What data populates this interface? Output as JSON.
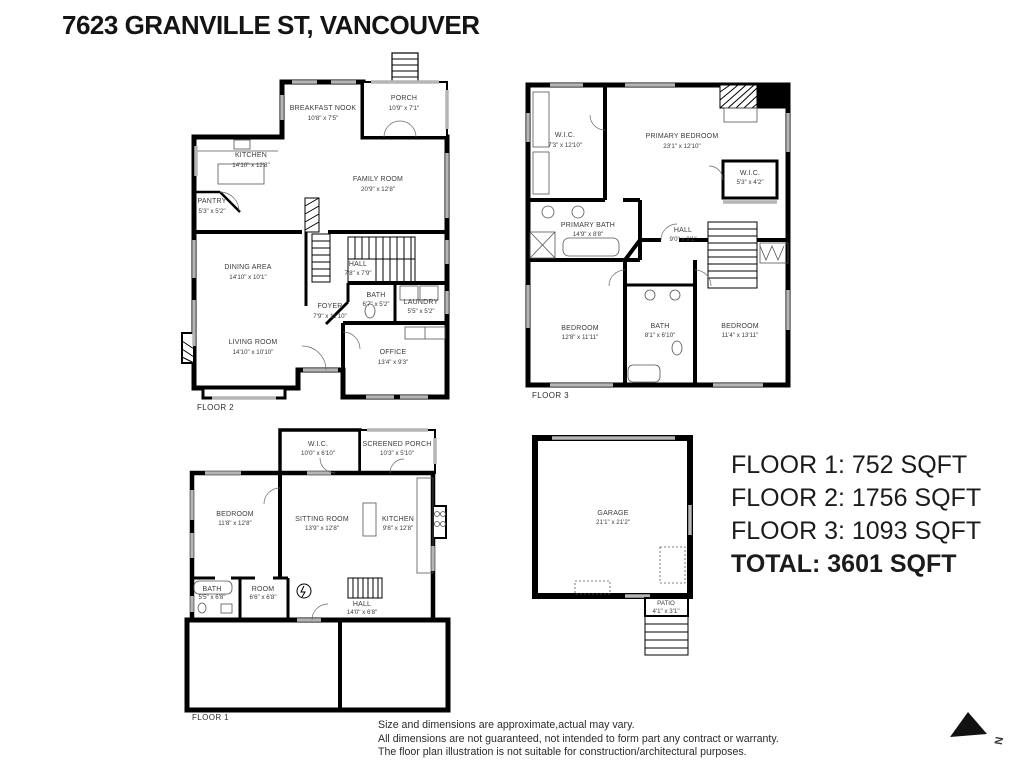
{
  "page": {
    "title": "7623 GRANVILLE ST, VANCOUVER"
  },
  "floor2": {
    "label": "FLOOR 2",
    "rooms": {
      "breakfast_nook": {
        "name": "BREAKFAST NOOK",
        "dims": "10'8\" x 7'5\""
      },
      "porch": {
        "name": "PORCH",
        "dims": "10'9\" x 7'1\""
      },
      "kitchen": {
        "name": "KITCHEN",
        "dims": "14'10\" x 12'8\""
      },
      "family_room": {
        "name": "FAMILY ROOM",
        "dims": "20'9\" x 12'8\""
      },
      "pantry": {
        "name": "PANTRY",
        "dims": "5'3\" x 5'2\""
      },
      "dining_area": {
        "name": "DINING AREA",
        "dims": "14'10\" x 10'1\""
      },
      "hall": {
        "name": "HALL",
        "dims": "7'8\" x 7'9\""
      },
      "foyer": {
        "name": "FOYER",
        "dims": "7'9\" x 11'10\""
      },
      "bath": {
        "name": "BATH",
        "dims": "6'7\" x 5'2\""
      },
      "laundry": {
        "name": "LAUNDRY",
        "dims": "5'5\" x 5'2\""
      },
      "living_room": {
        "name": "LIVING ROOM",
        "dims": "14'10\" x 10'10\""
      },
      "office": {
        "name": "OFFICE",
        "dims": "13'4\" x 9'3\""
      }
    }
  },
  "floor3": {
    "label": "FLOOR 3",
    "rooms": {
      "wic1": {
        "name": "W.I.C.",
        "dims": "7'3\" x 12'10\""
      },
      "primary_bedroom": {
        "name": "PRIMARY BEDROOM",
        "dims": "23'1\" x 12'10\""
      },
      "wic2": {
        "name": "W.I.C.",
        "dims": "5'3\" x 4'2\""
      },
      "primary_bath": {
        "name": "PRIMARY BATH",
        "dims": "14'9\" x 8'8\""
      },
      "hall": {
        "name": "HALL",
        "dims": "9'0\" x 9'1\""
      },
      "bedroom_left": {
        "name": "BEDROOM",
        "dims": "12'8\" x 11'11\""
      },
      "bath": {
        "name": "BATH",
        "dims": "8'1\" x 6'10\""
      },
      "bedroom_right": {
        "name": "BEDROOM",
        "dims": "11'4\" x 13'11\""
      }
    }
  },
  "floor1": {
    "label": "FLOOR 1",
    "rooms": {
      "wic": {
        "name": "W.I.C.",
        "dims": "10'0\" x 6'10\""
      },
      "screened_porch": {
        "name": "SCREENED PORCH",
        "dims": "10'3\" x 5'10\""
      },
      "bedroom": {
        "name": "BEDROOM",
        "dims": "11'8\" x 12'8\""
      },
      "sitting_room": {
        "name": "SITTING ROOM",
        "dims": "13'9\" x 12'8\""
      },
      "kitchen": {
        "name": "KITCHEN",
        "dims": "9'8\" x 12'8\""
      },
      "bath": {
        "name": "BATH",
        "dims": "5'5\" x 6'8\""
      },
      "room": {
        "name": "ROOM",
        "dims": "6'6\" x 6'8\""
      },
      "hall": {
        "name": "HALL",
        "dims": "14'0\" x 6'8\""
      }
    }
  },
  "garage_block": {
    "garage": {
      "name": "GARAGE",
      "dims": "21'1\" x 21'2\""
    },
    "patio": {
      "name": "PATIO",
      "dims": "4'1\" x 3'1\""
    }
  },
  "summary": {
    "lines": [
      "FLOOR 1: 752 SQFT",
      "FLOOR 2: 1756 SQFT",
      "FLOOR 3: 1093 SQFT"
    ],
    "total": "TOTAL: 3601 SQFT"
  },
  "disclaimer": {
    "lines": [
      "Size and dimensions are approximate,actual may vary.",
      "All dimensions are not guaranteed, not intended to form part any contract or warranty.",
      "The floor plan illustration is not suitable for construction/architectural purposes."
    ]
  },
  "compass": {
    "label": "N"
  },
  "colors": {
    "wall": "#000000",
    "window": "#b5b5b5",
    "text": "#3b3b3b"
  }
}
